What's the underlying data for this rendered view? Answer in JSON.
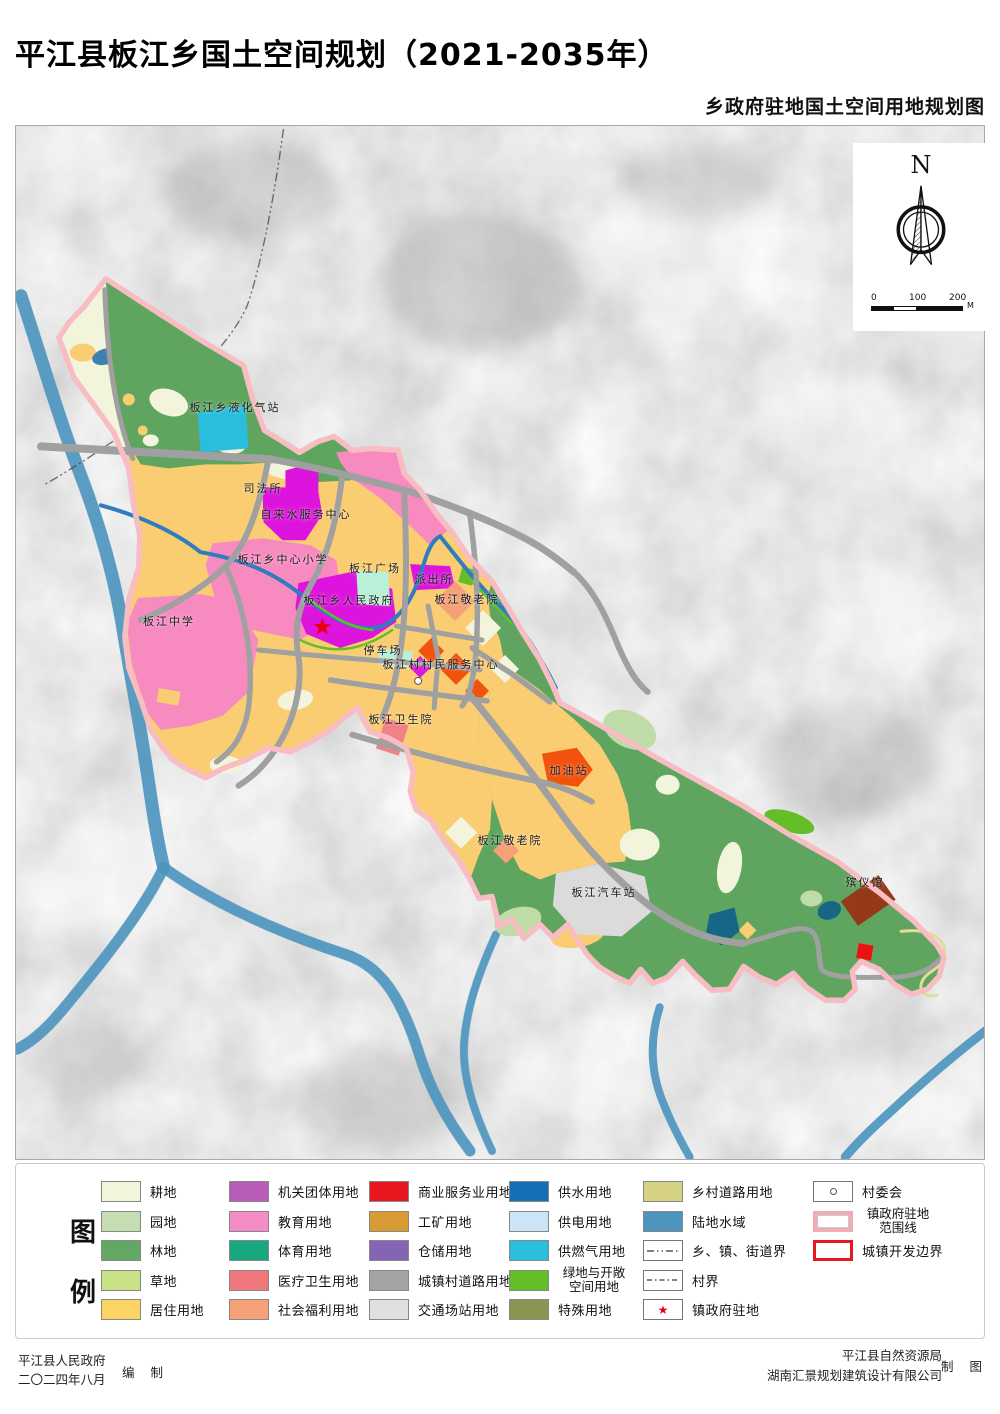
{
  "title": "平江县板江乡国土空间规划（2021-2035年）",
  "subtitle": "乡政府驻地国土空间用地规划图",
  "compass": {
    "north": "N"
  },
  "scalebar": {
    "tick0": "0",
    "tick100": "100",
    "tick200": "200",
    "unit": "M"
  },
  "symbols": {
    "star": "★"
  },
  "map_labels": [
    {
      "text": "板江乡液化气站"
    },
    {
      "text": "司法所"
    },
    {
      "text": "自来水服务中心"
    },
    {
      "text": "板江乡中心小学"
    },
    {
      "text": "板江广场"
    },
    {
      "text": "派出所"
    },
    {
      "text": "板江敬老院"
    },
    {
      "text": "板江乡人民政府"
    },
    {
      "text": "板江中学"
    },
    {
      "text": "停车场"
    },
    {
      "text": "板江村村民服务中心"
    },
    {
      "text": "板江卫生院"
    },
    {
      "text": "加油站"
    },
    {
      "text": "板江敬老院"
    },
    {
      "text": "板江汽车站"
    },
    {
      "text": "殡仪馆"
    }
  ],
  "legend": {
    "heading": [
      "图",
      "例"
    ],
    "columns": [
      {
        "items": [
          {
            "label": "耕地",
            "color": "#F2F5DC"
          },
          {
            "label": "园地",
            "color": "#C5DDB2"
          },
          {
            "label": "林地",
            "color": "#63A764"
          },
          {
            "label": "草地",
            "color": "#C9E287"
          },
          {
            "label": "居住用地",
            "color": "#FBD465"
          }
        ]
      },
      {
        "items": [
          {
            "label": "机关团体用地",
            "color": "#B85CB8"
          },
          {
            "label": "教育用地",
            "color": "#F48CC6"
          },
          {
            "label": "体育用地",
            "color": "#19A780"
          },
          {
            "label": "医疗卫生用地",
            "color": "#F0787C"
          },
          {
            "label": "社会福利用地",
            "color": "#F5A077"
          }
        ]
      },
      {
        "items": [
          {
            "label": "商业服务业用地",
            "color": "#E8171F"
          },
          {
            "label": "工矿用地",
            "color": "#D89A33"
          },
          {
            "label": "仓储用地",
            "color": "#8465B4"
          },
          {
            "label": "城镇村道路用地",
            "color": "#A3A3A3"
          },
          {
            "label": "交通场站用地",
            "color": "#E0E0E0"
          }
        ]
      },
      {
        "items": [
          {
            "label": "供水用地",
            "color": "#1470B4"
          },
          {
            "label": "供电用地",
            "color": "#CCE5F6"
          },
          {
            "label": "供燃气用地",
            "color": "#2ABEDE"
          },
          {
            "label": "绿地与开敞空间用地",
            "color": "#64BE28"
          },
          {
            "label": "特殊用地",
            "color": "#8A9552"
          }
        ]
      },
      {
        "items": [
          {
            "label": "乡村道路用地",
            "color": "#D5D383"
          },
          {
            "label": "陆地水域",
            "color": "#4E95BE"
          },
          {
            "label": "乡、镇、街道界",
            "type": "line-dashdot"
          },
          {
            "label": "村界",
            "type": "line-dash"
          },
          {
            "label": "镇政府驻地",
            "type": "star"
          }
        ]
      },
      {
        "items": [
          {
            "label": "村委会",
            "type": "circle"
          },
          {
            "label": "镇政府驻地范围线",
            "type": "outline-pink"
          },
          {
            "label": "城镇开发边界",
            "type": "outline-red"
          }
        ]
      }
    ]
  },
  "footer": {
    "left_line1": "平江县人民政府",
    "left_line2": "二〇二四年八月",
    "left_role": "编  制",
    "right_line1": "平江县自然资源局",
    "right_line2": "湖南汇景规划建筑设计有限公司",
    "right_role": "制  图"
  },
  "colors": {
    "cultivated": "#F2F5DC",
    "orchard": "#BFDBA8",
    "forest": "#5FA55F",
    "residential": "#FACD72",
    "education": "#F78BC0",
    "government": "#DD14DD",
    "welfare": "#F5A077",
    "medical": "#EF8287",
    "commercial_orange": "#F1530D",
    "commercial_red": "#EE1111",
    "mint": "#B9F0D8",
    "gas": "#2ABEDE",
    "transport": "#DBDBDB",
    "green_open": "#64BE28",
    "special_brown": "#96391B",
    "water_dark": "#176685",
    "rural_road": "#E0DC9A",
    "water": "#4E95BE",
    "stream": "#2F7CBE",
    "road": "#A0A0A0",
    "boundary": "#F7BDC2",
    "pond": "#3E80B0",
    "star": "#E60012"
  }
}
